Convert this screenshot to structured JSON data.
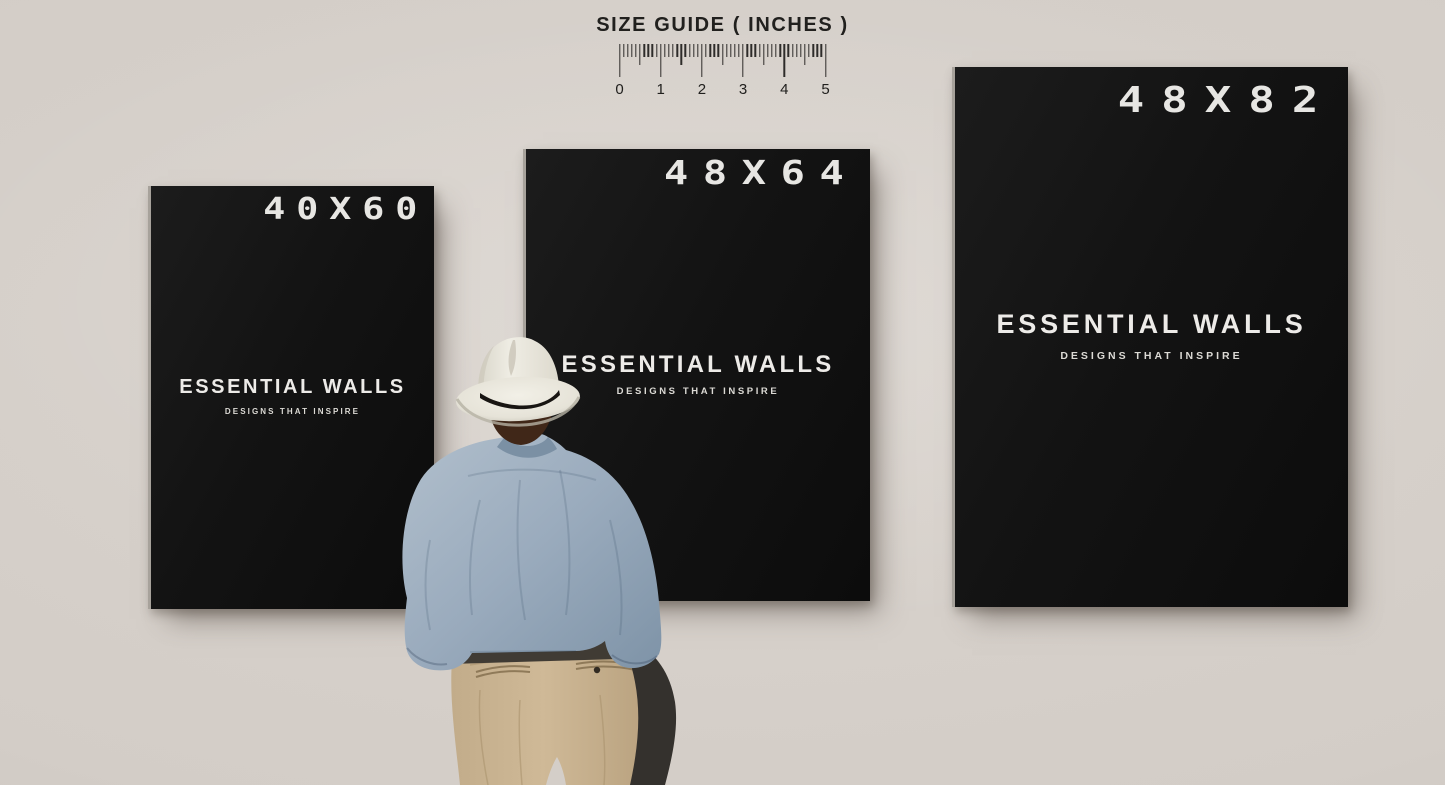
{
  "size_guide": {
    "title": "SIZE GUIDE ( INCHES )",
    "tick_labels": [
      "0",
      "1",
      "2",
      "3",
      "4",
      "5"
    ],
    "minor_ticks_per_inch": 10
  },
  "posters": [
    {
      "size_label": "40X60",
      "brand": "ESSENTIAL WALLS",
      "tagline": "DESIGNS THAT INSPIRE"
    },
    {
      "size_label": "48X64",
      "brand": "ESSENTIAL WALLS",
      "tagline": "DESIGNS THAT INSPIRE"
    },
    {
      "size_label": "48X82",
      "brand": "ESSENTIAL WALLS",
      "tagline": "DESIGNS THAT INSPIRE"
    }
  ],
  "colors": {
    "wall": "#d3cdc7",
    "poster_background": "#121212",
    "poster_text": "#e7e6e3",
    "ruler_ink": "#2e2c2a",
    "hat": "#e9e6de",
    "hat_band": "#181512",
    "shirt": "#9cadbf",
    "pants": "#c6b08f",
    "hair": "#402718"
  }
}
